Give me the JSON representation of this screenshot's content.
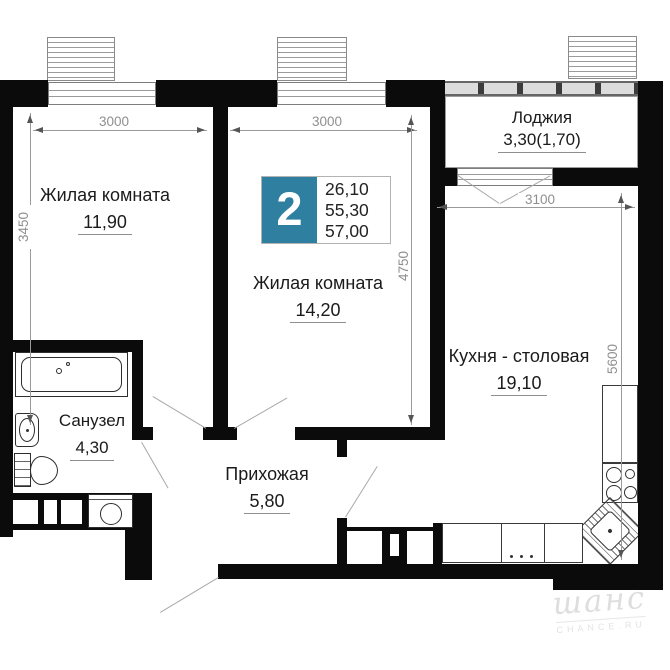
{
  "plan": {
    "badge": {
      "rooms_count": "2",
      "areas": [
        "26,10",
        "55,30",
        "57,00"
      ]
    },
    "rooms": {
      "room1": {
        "name": "Жилая комната",
        "area": "11,90"
      },
      "room2": {
        "name": "Жилая комната",
        "area": "14,20"
      },
      "kitchen": {
        "name": "Кухня - столовая",
        "area": "19,10"
      },
      "bathroom": {
        "name": "Санузел",
        "area": "4,30"
      },
      "hallway": {
        "name": "Прихожая",
        "area": "5,80"
      },
      "loggia": {
        "name": "Лоджия",
        "area": "3,30(1,70)"
      }
    },
    "dimensions": {
      "room1_width": "3000",
      "room1_height": "3450",
      "room2_width": "3000",
      "room2_height": "4750",
      "kitchen_width": "3100",
      "kitchen_height": "5600"
    },
    "watermark": {
      "logo": "шанс",
      "site": "CHANCE.RU"
    },
    "colors": {
      "badge_accent": "#2f7fa0",
      "wall": "#0b0b0b"
    }
  }
}
